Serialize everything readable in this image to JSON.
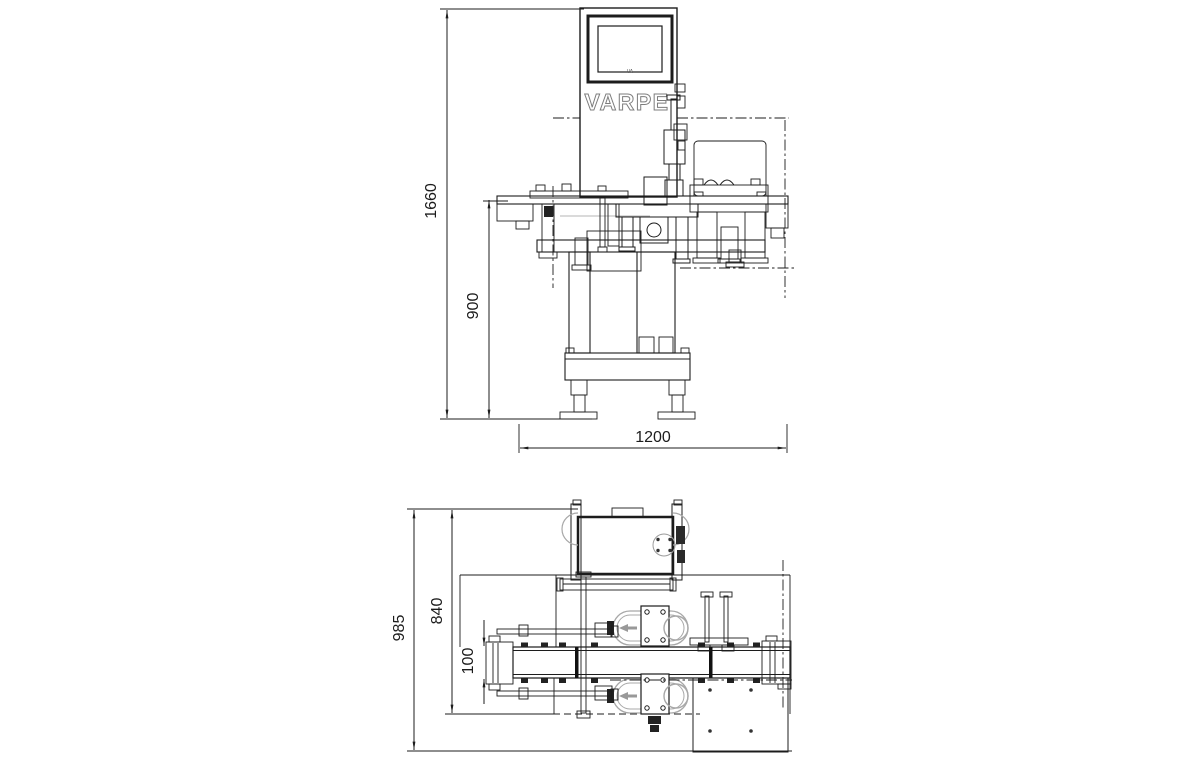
{
  "drawing": {
    "brand": "VARPE",
    "screen_badge": "VA",
    "dims": {
      "front": {
        "overall_height": "1660",
        "belt_height": "900",
        "overall_width": "1200"
      },
      "plan": {
        "overall_depth": "985",
        "frame_depth": "840",
        "belt_width": "100"
      }
    },
    "colors": {
      "line": "#1c1c1c",
      "light_gray": "#a8a8a8"
    }
  }
}
